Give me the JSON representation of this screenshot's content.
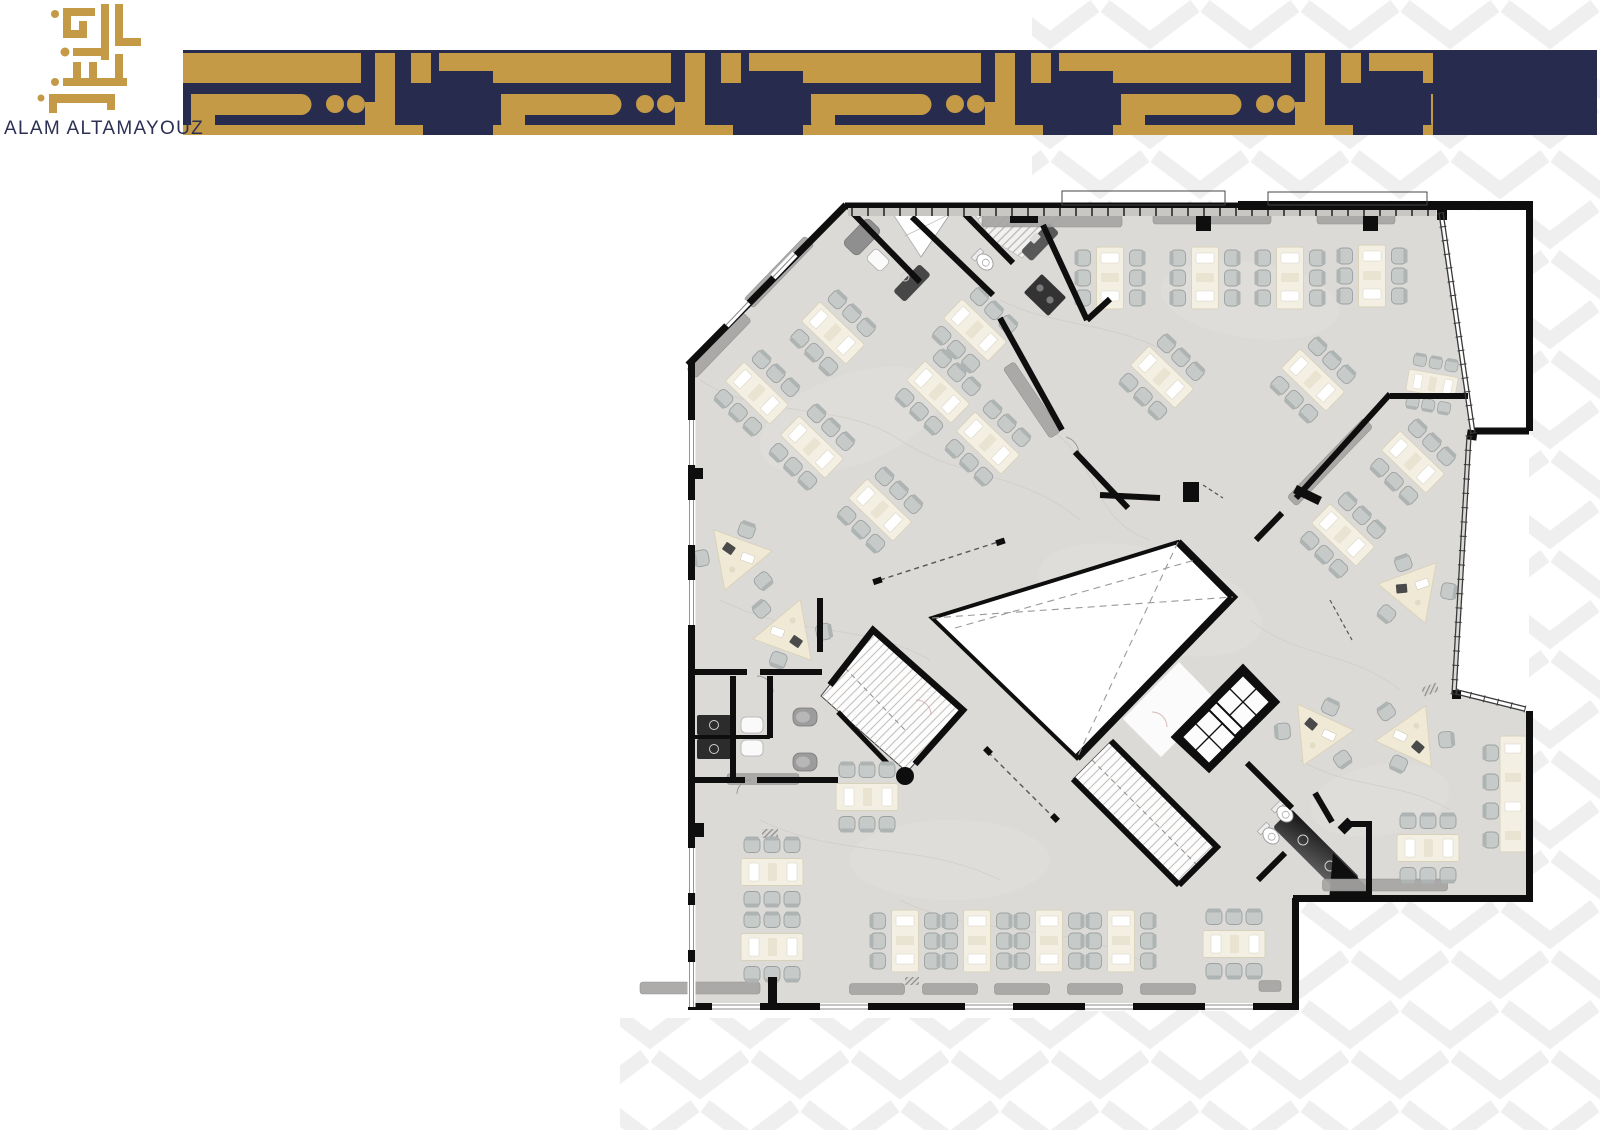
{
  "brand": {
    "logo_text": "ALAM ALTAMAYOUZ",
    "gold": "#C49A47",
    "navy": "#272B4E"
  },
  "header": {
    "band_style": "kufic-calligraphy-pattern",
    "band_solid_cap": "navy"
  },
  "background": {
    "pattern": "chevron",
    "pattern_color": "#EFEFEF"
  },
  "floor_plan": {
    "wall_color": "#0E0E0E",
    "floor_color": "#DCDAD7",
    "desk_color": "#F3EFE2",
    "chair_color": "#C6CAC9",
    "desks": [
      [
        1110,
        278,
        0,
        1
      ],
      [
        1205,
        278,
        0,
        1
      ],
      [
        1290,
        278,
        0,
        1
      ],
      [
        1372,
        276,
        0,
        1
      ],
      [
        833,
        333,
        -46,
        1
      ],
      [
        975,
        330,
        -46,
        1
      ],
      [
        757,
        393,
        -46,
        1
      ],
      [
        938,
        392,
        -46,
        1
      ],
      [
        812,
        447,
        -46,
        1
      ],
      [
        988,
        443,
        -46,
        1
      ],
      [
        880,
        510,
        -46,
        1
      ],
      [
        1162,
        377,
        -46,
        1
      ],
      [
        1313,
        380,
        -46,
        1
      ],
      [
        1413,
        462,
        -46,
        1
      ],
      [
        1343,
        535,
        -46,
        1
      ],
      [
        1432,
        384,
        100,
        0.8
      ],
      [
        867,
        797,
        90,
        1
      ],
      [
        772,
        872,
        90,
        1
      ],
      [
        772,
        947,
        90,
        1
      ],
      [
        905,
        941,
        0,
        1
      ],
      [
        977,
        941,
        0,
        1
      ],
      [
        1049,
        941,
        0,
        1
      ],
      [
        1121,
        941,
        0,
        1
      ],
      [
        1234,
        944,
        90,
        1
      ],
      [
        1428,
        848,
        90,
        1
      ]
    ],
    "triangle_desks": [
      [
        735,
        562,
        200
      ],
      [
        790,
        628,
        20
      ],
      [
        1316,
        738,
        205
      ],
      [
        1413,
        733,
        25
      ],
      [
        1415,
        595,
        160
      ]
    ],
    "sideboards": [
      [
        779,
        272,
        88,
        13,
        -46
      ],
      [
        719,
        345,
        80,
        13,
        -46
      ],
      [
        1032,
        400,
        84,
        13,
        56
      ],
      [
        1330,
        462,
        110,
        13,
        -46
      ],
      [
        1052,
        221,
        140,
        12,
        0
      ],
      [
        1212,
        218,
        118,
        12,
        0
      ],
      [
        1356,
        218,
        78,
        12,
        0
      ],
      [
        700,
        988,
        120,
        12,
        0
      ],
      [
        877,
        989,
        55,
        11,
        0
      ],
      [
        950,
        989,
        55,
        11,
        0
      ],
      [
        1022,
        989,
        55,
        11,
        0
      ],
      [
        1095,
        989,
        55,
        11,
        0
      ],
      [
        1168,
        989,
        55,
        11,
        0
      ],
      [
        1270,
        986,
        22,
        11,
        0
      ],
      [
        1385,
        885,
        125,
        12,
        0
      ],
      [
        763,
        779,
        72,
        11,
        0
      ]
    ]
  }
}
